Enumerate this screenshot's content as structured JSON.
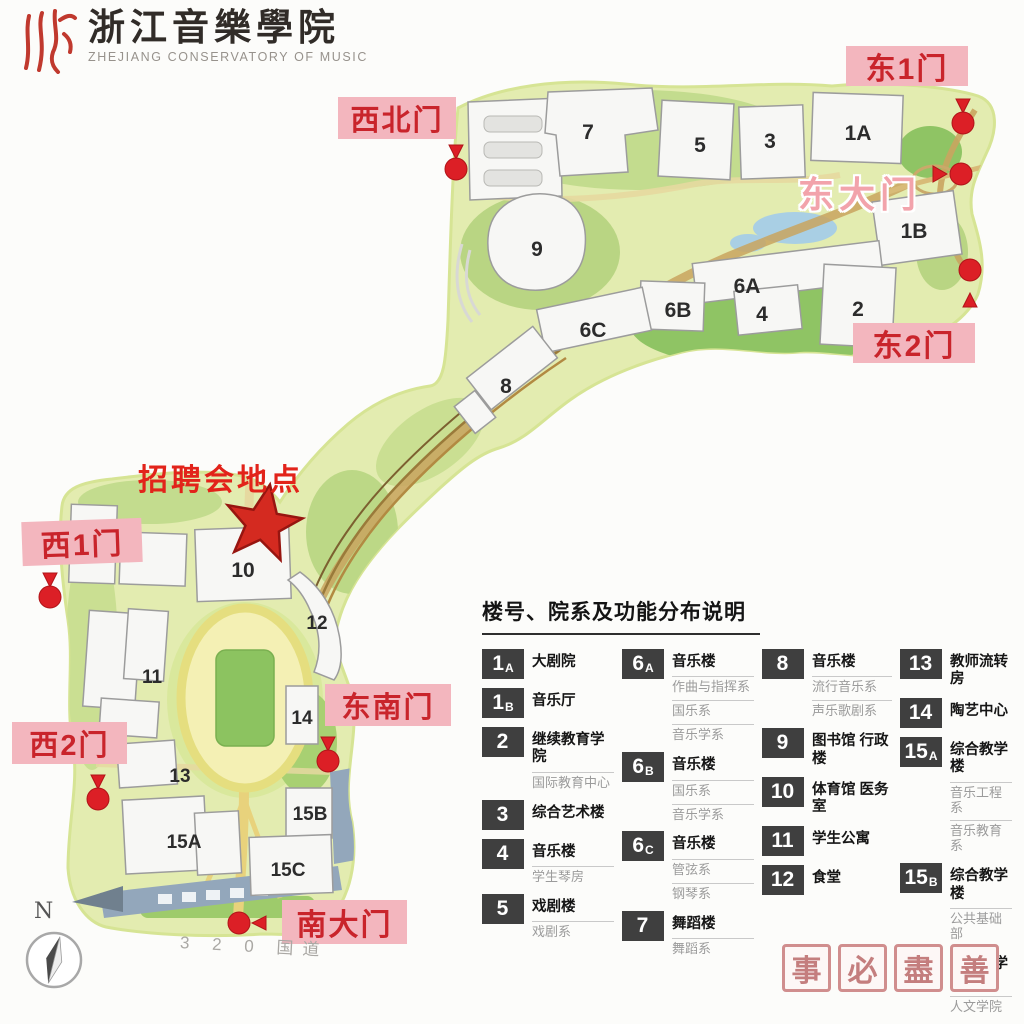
{
  "logo": {
    "seal_icon": "zhe-calligraphy-seal",
    "title_cn": "浙江音樂學院",
    "title_en": "ZHEJIANG CONSERVATORY OF MUSIC"
  },
  "event_marker": {
    "label": "招聘会地点",
    "icon": "red-star"
  },
  "gates": {
    "northwest": "西北门",
    "east1": "东1门",
    "east_main": "东大门",
    "east2": "东2门",
    "west1": "西1门",
    "west2": "西2门",
    "southeast": "东南门",
    "south_main": "南大门"
  },
  "map": {
    "buildings": {
      "b7": "7",
      "b5": "5",
      "b3": "3",
      "b1A": "1A",
      "b9": "9",
      "b1B": "1B",
      "b6A": "6A",
      "b2": "2",
      "b4": "4",
      "b6B": "6B",
      "b6C": "6C",
      "b8": "8",
      "b10": "10",
      "b12": "12",
      "b11": "11",
      "b13": "13",
      "b14": "14",
      "b15A": "15A",
      "b15B": "15B",
      "b15C": "15C"
    }
  },
  "legend": {
    "title": "楼号、院系及功能分布说明",
    "columns": [
      {
        "entries": [
          {
            "badge": "1",
            "suffix": "A",
            "name": "大剧院",
            "subs": []
          },
          {
            "badge": "1",
            "suffix": "B",
            "name": "音乐厅",
            "subs": []
          },
          {
            "badge": "2",
            "suffix": "",
            "name": "继续教育学院",
            "subs": [
              "国际教育中心"
            ]
          },
          {
            "badge": "3",
            "suffix": "",
            "name": "综合艺术楼",
            "subs": []
          },
          {
            "badge": "4",
            "suffix": "",
            "name": "音乐楼",
            "subs": [
              "学生琴房"
            ]
          },
          {
            "badge": "5",
            "suffix": "",
            "name": "戏剧楼",
            "subs": [
              "戏剧系"
            ]
          }
        ]
      },
      {
        "entries": [
          {
            "badge": "6",
            "suffix": "A",
            "name": "音乐楼",
            "subs": [
              "作曲与指挥系",
              "国乐系",
              "音乐学系"
            ]
          },
          {
            "badge": "6",
            "suffix": "B",
            "name": "音乐楼",
            "subs": [
              "国乐系",
              "音乐学系"
            ]
          },
          {
            "badge": "6",
            "suffix": "C",
            "name": "音乐楼",
            "subs": [
              "管弦系",
              "钢琴系"
            ]
          },
          {
            "badge": "7",
            "suffix": "",
            "name": "舞蹈楼",
            "subs": [
              "舞蹈系"
            ]
          }
        ]
      },
      {
        "entries": [
          {
            "badge": "8",
            "suffix": "",
            "name": "音乐楼",
            "subs": [
              "流行音乐系",
              "声乐歌剧系"
            ]
          },
          {
            "badge": "9",
            "suffix": "",
            "name": "图书馆 行政楼",
            "subs": []
          },
          {
            "badge": "10",
            "suffix": "",
            "name": "体育馆 医务室",
            "subs": []
          },
          {
            "badge": "11",
            "suffix": "",
            "name": "学生公寓",
            "subs": []
          },
          {
            "badge": "12",
            "suffix": "",
            "name": "食堂",
            "subs": []
          }
        ]
      },
      {
        "entries": [
          {
            "badge": "13",
            "suffix": "",
            "name": "教师流转房",
            "subs": []
          },
          {
            "badge": "14",
            "suffix": "",
            "name": "陶艺中心",
            "subs": []
          },
          {
            "badge": "15",
            "suffix": "A",
            "name": "综合教学楼",
            "subs": [
              "音乐工程系",
              "音乐教育系"
            ]
          },
          {
            "badge": "15",
            "suffix": "B",
            "name": "综合教学楼",
            "subs": [
              "公共基础部"
            ]
          },
          {
            "badge": "15",
            "suffix": "C",
            "name": "综合教学楼",
            "subs": [
              "人文学院"
            ]
          }
        ]
      }
    ]
  },
  "compass": {
    "label": "N"
  },
  "road": {
    "label": "3 2 0 国道"
  },
  "stamps": [
    "事",
    "必",
    "盡",
    "善"
  ],
  "colors": {
    "gate_label_bg": "#f3b6be",
    "gate_label_text": "#c9242b",
    "marker_red": "#dc1f26",
    "event_text": "#e2231a",
    "campus_green": "#e3ecb0",
    "lawn_green": "#a8cc70",
    "badge_bg": "#3f3f3f",
    "stamp_red": "#cf8b8b",
    "logo_red": "#c0392e",
    "pond_blue": "#a9cfe4",
    "road_tan": "#c9a55f"
  }
}
